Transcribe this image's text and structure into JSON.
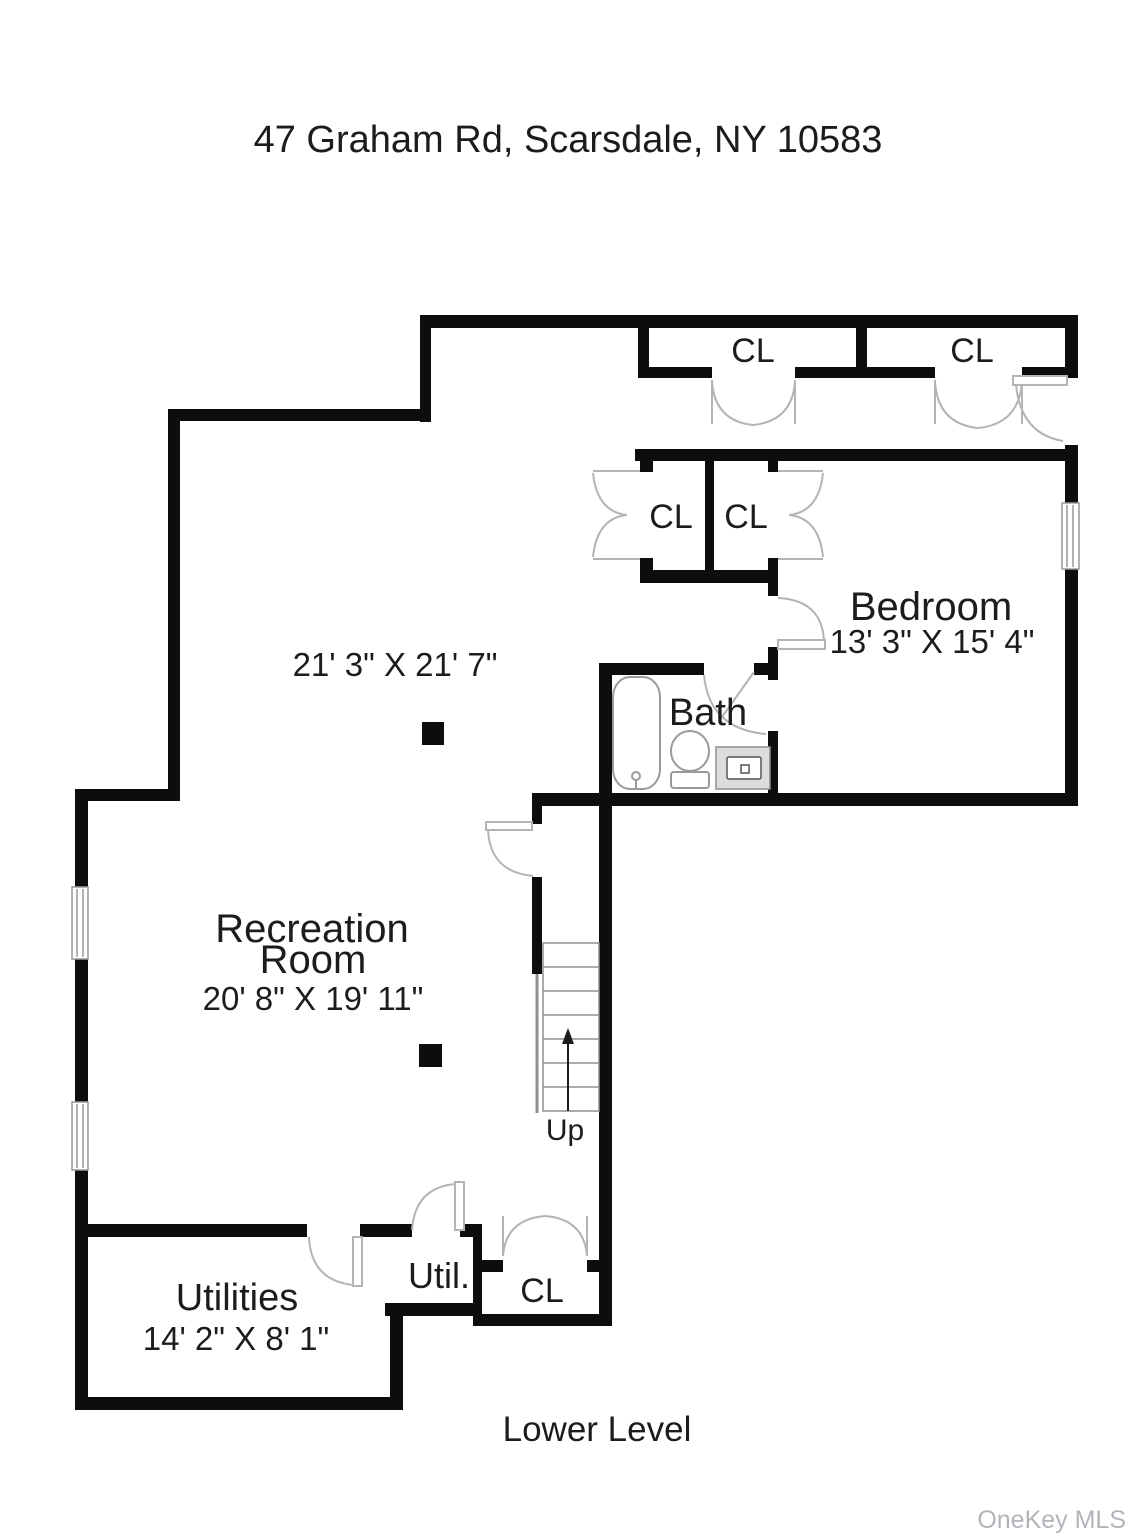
{
  "page": {
    "title": "47 Graham Rd, Scarsdale, NY 10583",
    "floor_label": "Lower Level",
    "watermark": "OneKey MLS"
  },
  "rooms": {
    "recreation": {
      "name_line1": "Recreation",
      "name_line2": "Room",
      "dims": "20' 8\" X 19' 11\"",
      "dims_secondary": "21' 3\" X 21' 7\""
    },
    "bedroom": {
      "name": "Bedroom",
      "dims": "13' 3\" X 15' 4\""
    },
    "bath": {
      "name": "Bath"
    },
    "utilities": {
      "name": "Utilities",
      "dims": "14' 2\" X 8' 1\""
    },
    "utility_closet": {
      "name": "Util."
    },
    "closets": {
      "top_left": "CL",
      "top_right": "CL",
      "mid_left": "CL",
      "mid_right": "CL",
      "bottom": "CL"
    }
  },
  "stairs": {
    "label": "Up",
    "direction": "up"
  },
  "colors": {
    "wall": "#0d0d0d",
    "door_swing": "#b4b4b4",
    "fixture_stroke": "#9a9a9a",
    "vanity_fill": "#dcdcdc",
    "text": "#1c1c1c",
    "watermark": "#b1b4b9"
  }
}
